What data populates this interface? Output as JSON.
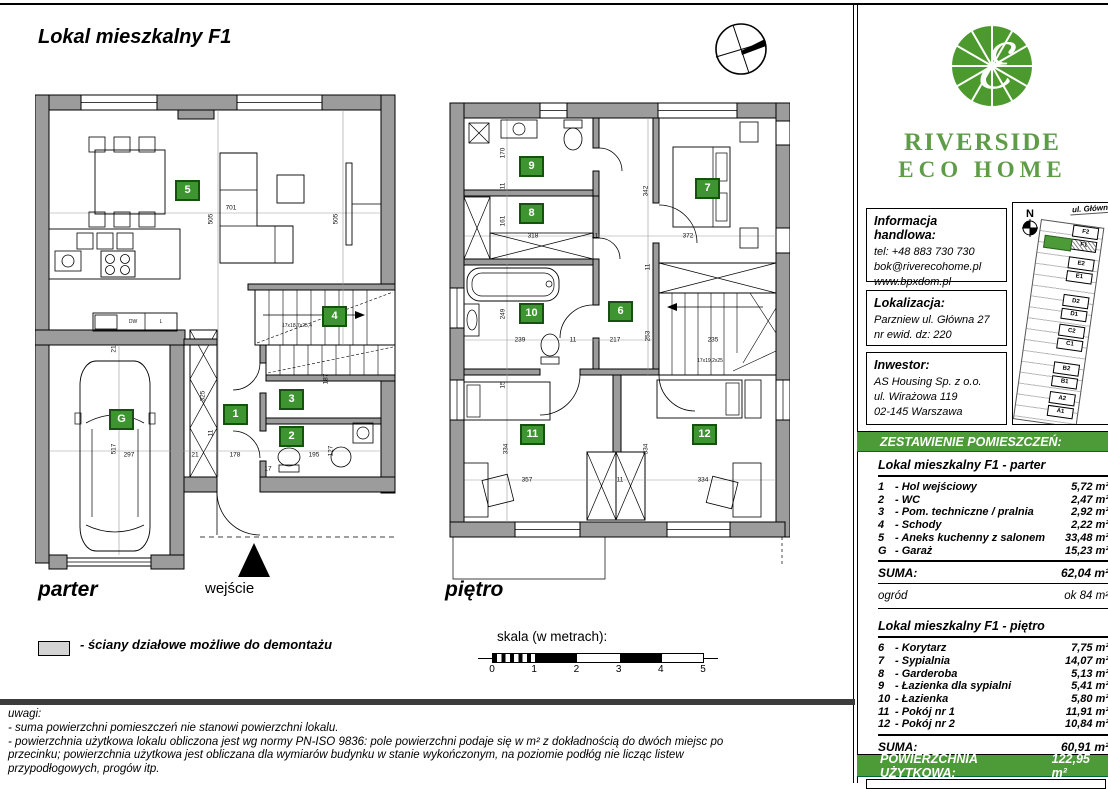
{
  "title": "Lokal mieszkalny F1",
  "labels": {
    "parter": "parter",
    "pietro": "piętro",
    "wejscie": "wejście",
    "legend": "- ściany działowe możliwe do demontażu",
    "scale_title": "skala (w metrach):",
    "scale_ticks": [
      "0",
      "1",
      "2",
      "3",
      "4",
      "5"
    ]
  },
  "notes": {
    "heading": "uwagi:",
    "lines": [
      "- suma powierzchni pomieszczeń nie stanowi powierzchni lokalu.",
      "- powierzchnia użytkowa lokalu obliczona jest wg normy PN-ISO 9836: pole powierzchni podaje się w m² z dokładnością do dwóch miejsc po",
      "  przecinku; powierzchnia użytkowa jest obliczana dla wymiarów budynku w stanie wykończonym, na poziomie podłóg nie licząc listew",
      "  przypodłogowych, progów itp."
    ]
  },
  "brand": {
    "line1": "RIVERSIDE",
    "line2": "ECO HOME",
    "green": "#4c9a2e"
  },
  "contact": {
    "heading": "Informacja handlowa:",
    "lines": [
      "tel: +48 883 730 730",
      "bok@riverecohome.pl",
      "www.bpxdom.pl"
    ]
  },
  "location": {
    "heading": "Lokalizacja:",
    "lines": [
      "Parzniew ul. Główna 27",
      "nr ewid. dz: 220"
    ]
  },
  "investor": {
    "heading": "Inwestor:",
    "lines": [
      "AS Housing Sp. z o.o.",
      "ul. Wirażowa 119",
      "02-145 Warszawa"
    ]
  },
  "siteplan": {
    "street": "ul. Główna",
    "north": "N",
    "units": [
      "F2",
      "F1",
      "E2",
      "E1",
      "D2",
      "D1",
      "C2",
      "C1",
      "B2",
      "B1",
      "A2",
      "A1"
    ],
    "highlight": "F1"
  },
  "schedule": {
    "header": "ZESTAWIENIE POMIESZCZEŃ:",
    "unit": "m²",
    "parter": {
      "title": "Lokal mieszkalny F1 - parter",
      "rows": [
        {
          "no": "1",
          "name": "Hol wejściowy",
          "area": "5,72"
        },
        {
          "no": "2",
          "name": "WC",
          "area": "2,47"
        },
        {
          "no": "3",
          "name": "Pom. techniczne / pralnia",
          "area": "2,92"
        },
        {
          "no": "4",
          "name": "Schody",
          "area": "2,22"
        },
        {
          "no": "5",
          "name": "Aneks kuchenny z salonem",
          "area": "33,48"
        },
        {
          "no": "G",
          "name": "Garaż",
          "area": "15,23"
        }
      ],
      "suma_label": "SUMA:",
      "suma": "62,04",
      "extra_label": "ogród",
      "extra_value": "ok 84"
    },
    "pietro": {
      "title": "Lokal mieszkalny F1 - piętro",
      "rows": [
        {
          "no": "6",
          "name": "Korytarz",
          "area": "7,75"
        },
        {
          "no": "7",
          "name": "Sypialnia",
          "area": "14,07"
        },
        {
          "no": "8",
          "name": "Garderoba",
          "area": "5,13"
        },
        {
          "no": "9",
          "name": "Łazienka dla sypialni",
          "area": "5,41"
        },
        {
          "no": "10",
          "name": "Łazienka",
          "area": "5,80"
        },
        {
          "no": "11",
          "name": "Pokój nr 1",
          "area": "11,91"
        },
        {
          "no": "12",
          "name": "Pokój nr 2",
          "area": "10,84"
        }
      ],
      "suma_label": "SUMA:",
      "suma": "60,91"
    },
    "total_label": "POWIERZCHNIA UŻYTKOWA:",
    "total": "122,95"
  },
  "plans": {
    "parter": {
      "badges": [
        {
          "t": "5",
          "x": 140,
          "y": 87
        },
        {
          "t": "4",
          "x": 287,
          "y": 213
        },
        {
          "t": "1",
          "x": 188,
          "y": 311
        },
        {
          "t": "3",
          "x": 244,
          "y": 296
        },
        {
          "t": "2",
          "x": 244,
          "y": 333
        },
        {
          "t": "G",
          "x": 74,
          "y": 316
        }
      ],
      "dims": [
        {
          "t": "701",
          "x": 196,
          "y": 115
        },
        {
          "t": "505",
          "x": 176,
          "y": 126,
          "r": 1
        },
        {
          "t": "505",
          "x": 301,
          "y": 126,
          "r": 1
        },
        {
          "t": "21",
          "x": 79,
          "y": 256,
          "r": 1
        },
        {
          "t": "325",
          "x": 168,
          "y": 303,
          "r": 1
        },
        {
          "t": "517",
          "x": 79,
          "y": 356,
          "r": 1
        },
        {
          "t": "187",
          "x": 291,
          "y": 286,
          "r": 1
        },
        {
          "t": "127",
          "x": 296,
          "y": 358,
          "r": 1
        },
        {
          "t": "11",
          "x": 176,
          "y": 340,
          "r": 1
        },
        {
          "t": "297",
          "x": 94,
          "y": 362
        },
        {
          "t": "21",
          "x": 160,
          "y": 362
        },
        {
          "t": "178",
          "x": 200,
          "y": 362
        },
        {
          "t": "195",
          "x": 279,
          "y": 362
        },
        {
          "t": "17",
          "x": 233,
          "y": 376
        },
        {
          "t": "17x18,7x25,4",
          "x": 262,
          "y": 233,
          "s": 5
        },
        {
          "t": "DW",
          "x": 98,
          "y": 229,
          "s": 5
        },
        {
          "t": "L",
          "x": 126,
          "y": 229,
          "s": 5
        }
      ]
    },
    "pietro": {
      "badges": [
        {
          "t": "9",
          "x": 74,
          "y": 63
        },
        {
          "t": "8",
          "x": 74,
          "y": 110
        },
        {
          "t": "7",
          "x": 250,
          "y": 85
        },
        {
          "t": "10",
          "x": 74,
          "y": 210
        },
        {
          "t": "6",
          "x": 163,
          "y": 208
        },
        {
          "t": "11",
          "x": 75,
          "y": 331
        },
        {
          "t": "12",
          "x": 247,
          "y": 331
        }
      ],
      "dims": [
        {
          "t": "170",
          "x": 58,
          "y": 60,
          "r": 1
        },
        {
          "t": "11",
          "x": 58,
          "y": 93,
          "r": 1
        },
        {
          "t": "161",
          "x": 58,
          "y": 128,
          "r": 1
        },
        {
          "t": "318",
          "x": 88,
          "y": 143
        },
        {
          "t": "11",
          "x": 150,
          "y": 143
        },
        {
          "t": "372",
          "x": 243,
          "y": 143
        },
        {
          "t": "342",
          "x": 201,
          "y": 98,
          "r": 1
        },
        {
          "t": "249",
          "x": 58,
          "y": 221,
          "r": 1
        },
        {
          "t": "253",
          "x": 203,
          "y": 243,
          "r": 1
        },
        {
          "t": "11",
          "x": 203,
          "y": 174,
          "r": 1
        },
        {
          "t": "239",
          "x": 75,
          "y": 247
        },
        {
          "t": "11",
          "x": 128,
          "y": 247
        },
        {
          "t": "217",
          "x": 170,
          "y": 247
        },
        {
          "t": "235",
          "x": 268,
          "y": 247
        },
        {
          "t": "15",
          "x": 58,
          "y": 292,
          "r": 1
        },
        {
          "t": "334",
          "x": 61,
          "y": 356,
          "r": 1
        },
        {
          "t": "334",
          "x": 201,
          "y": 356,
          "r": 1
        },
        {
          "t": "357",
          "x": 82,
          "y": 387
        },
        {
          "t": "11",
          "x": 175,
          "y": 387
        },
        {
          "t": "334",
          "x": 258,
          "y": 387
        },
        {
          "t": "17x19,2x25",
          "x": 265,
          "y": 268,
          "s": 5
        }
      ]
    }
  }
}
